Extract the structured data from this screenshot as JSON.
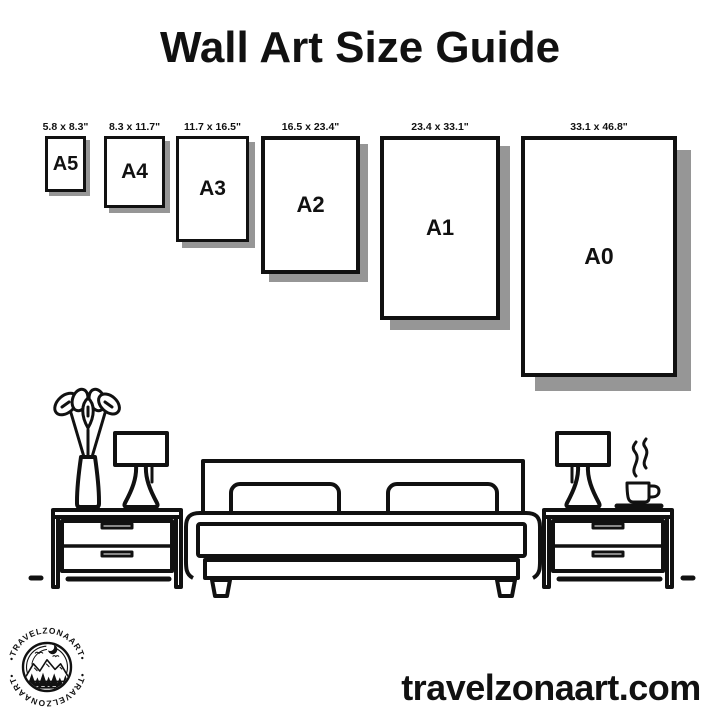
{
  "page": {
    "title": "Wall Art Size Guide",
    "website": "travelzonaart.com"
  },
  "size_guide": {
    "items": [
      {
        "name": "A5",
        "dimensions": "5.8 x 8.3\""
      },
      {
        "name": "A4",
        "dimensions": "8.3 x 11.7\""
      },
      {
        "name": "A3",
        "dimensions": "11.7 x 16.5\""
      },
      {
        "name": "A2",
        "dimensions": "16.5 x 23.4\""
      },
      {
        "name": "A1",
        "dimensions": "23.4 x 33.1\""
      },
      {
        "name": "A0",
        "dimensions": "33.1 x 46.8\""
      }
    ]
  },
  "logo": {
    "text_top": "•TRAVELZONAART•",
    "text_bottom": "•TRAVELZONAART•"
  },
  "colors": {
    "ink": "#111111",
    "paper_shadow": "#969696",
    "background": "#ffffff"
  },
  "illustration": {
    "elements": [
      "plant-vase",
      "table-lamp-left",
      "nightstand-left",
      "bed",
      "nightstand-right",
      "table-lamp-right",
      "coffee-cup",
      "floor-line"
    ]
  }
}
